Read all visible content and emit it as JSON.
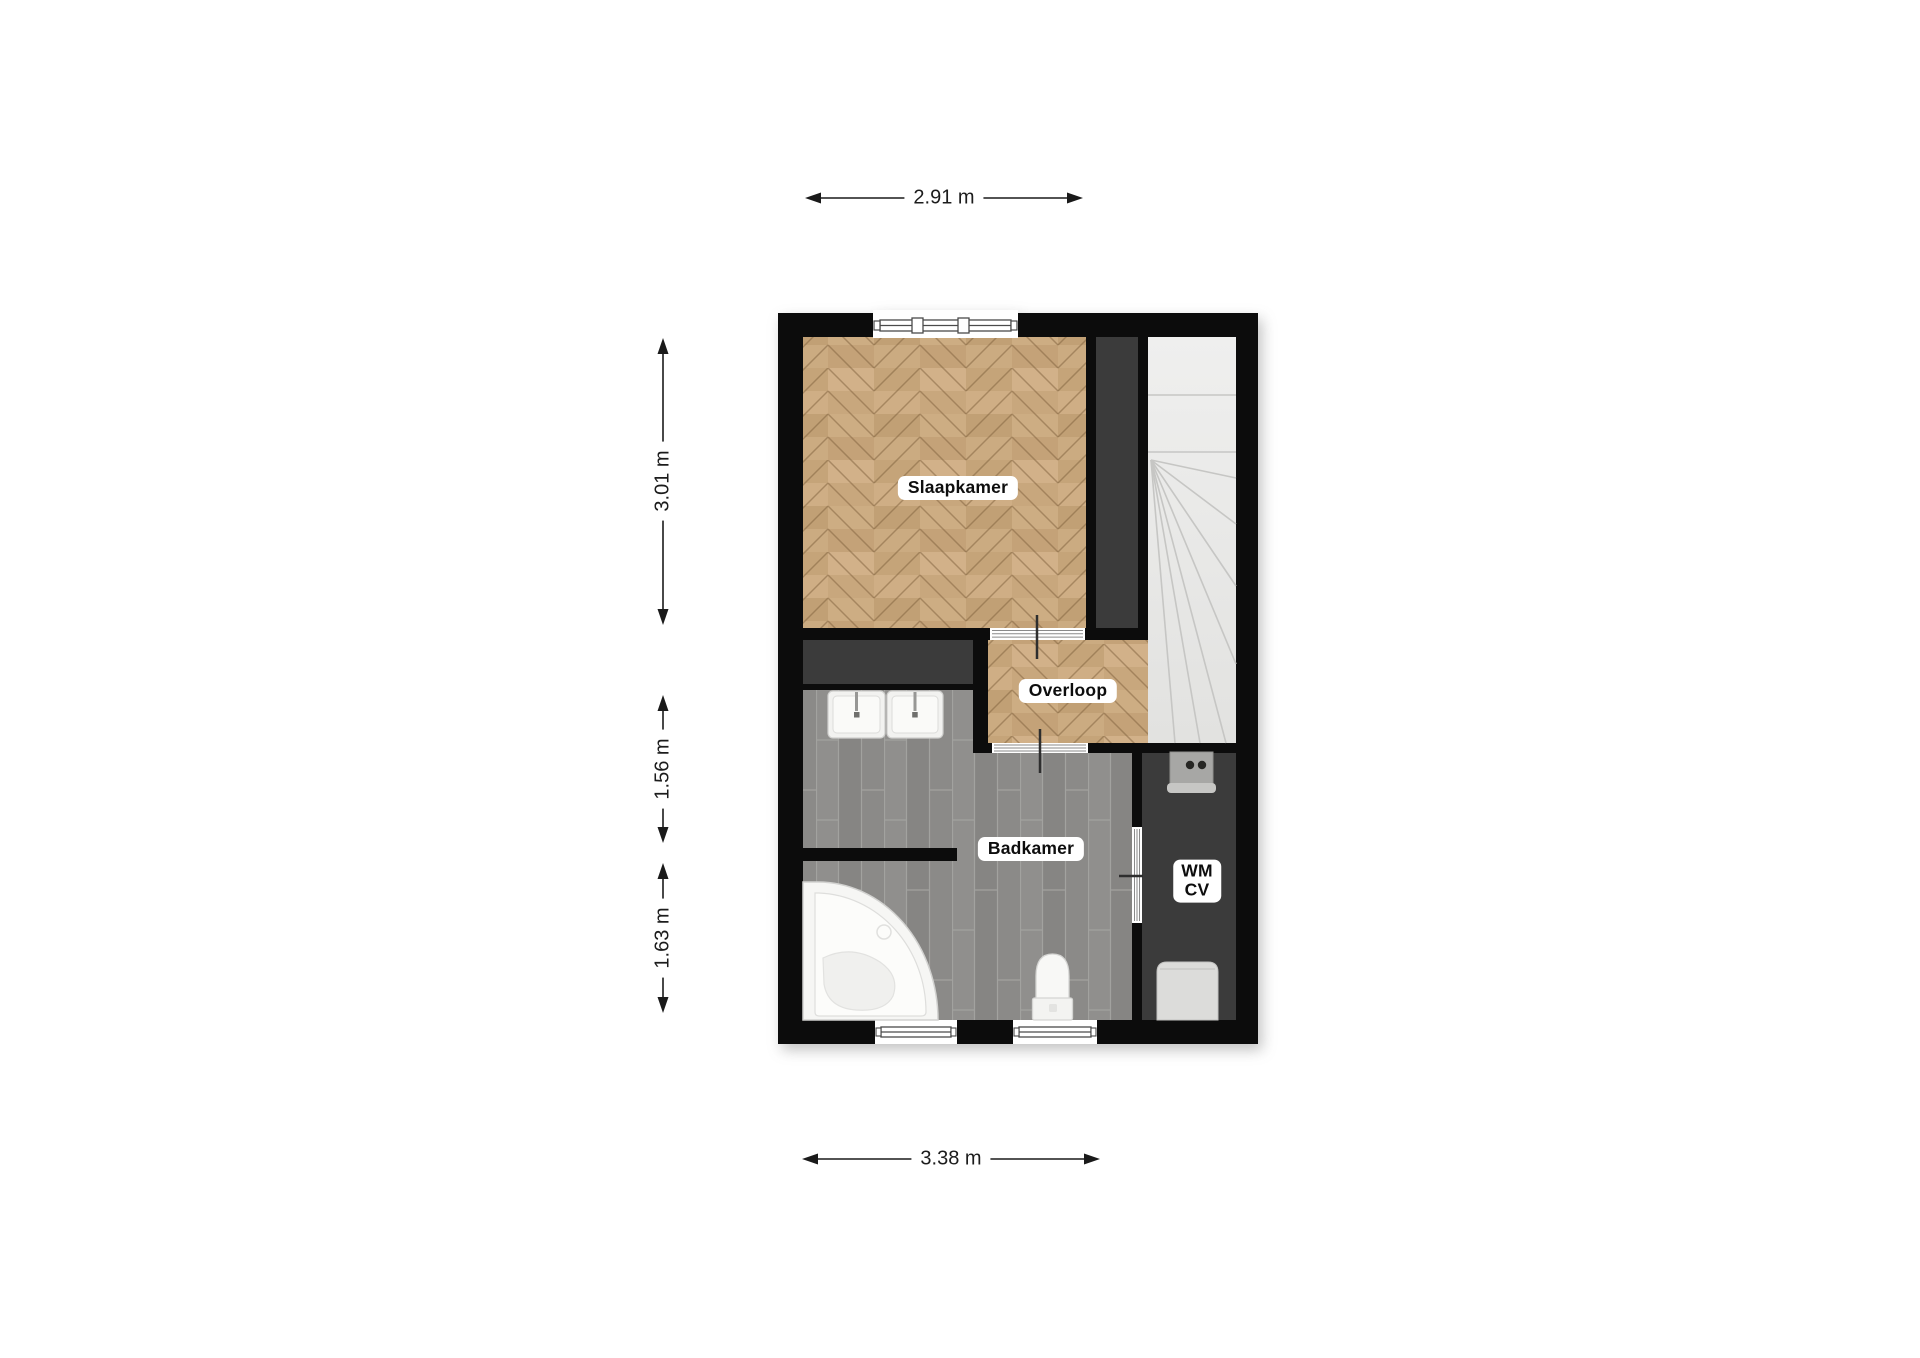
{
  "meta": {
    "type": "floorplan",
    "floor_shown": "upper floor with bedroom, landing, bathroom"
  },
  "rooms": [
    {
      "id": "slaapkamer",
      "label": "Slaapkamer"
    },
    {
      "id": "overloop",
      "label": "Overloop"
    },
    {
      "id": "badkamer",
      "label": "Badkamer"
    },
    {
      "id": "wm-cv-closet",
      "label": "WM\nCV"
    }
  ],
  "dimensions": {
    "top_width": "2.91 m",
    "left_top": "3.01 m",
    "left_middle": "1.56 m",
    "left_bottom": "1.63 m",
    "bottom_width": "3.38 m"
  },
  "fixtures": [
    "double-washbasin",
    "corner-bath",
    "toilet",
    "washing-machine",
    "cv-boiler",
    "staircase",
    "top-window",
    "two-bottom-windows",
    "door-slaapkamer-overloop",
    "door-overloop-badkamer",
    "door-badkamer-closet"
  ],
  "colors": {
    "wall": "#0c0c0c",
    "parquet": "#c9aa80",
    "bathroom_tile": "#8d8d8b",
    "closet_void": "#3b3b3b",
    "stairs": "#e8e8e7",
    "fixture_white": "#f6f6f4",
    "background": "#ffffff",
    "dimension_line": "#1a1a1a"
  }
}
